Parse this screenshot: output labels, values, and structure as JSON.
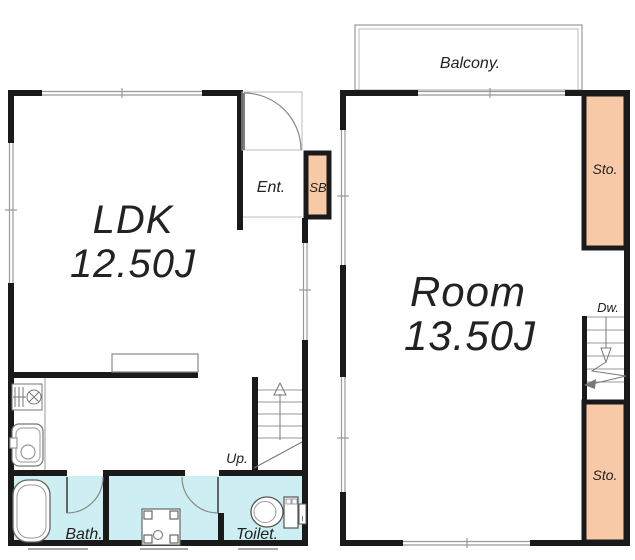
{
  "colors": {
    "wall": "#1a1a1a",
    "thin_line": "#999999",
    "fixture_line": "#666666",
    "storage_fill": "#f7c9a6",
    "wet_area_fill": "#cdeef2",
    "background": "#ffffff",
    "text": "#222222"
  },
  "floor1": {
    "room_label": "LDK",
    "room_size": "12.50J",
    "entrance_label": "Ent.",
    "shoebox_label": "SB",
    "stairs_label": "Up.",
    "bath_label": "Bath.",
    "toilet_label": "Toilet."
  },
  "floor2": {
    "room_label": "Room",
    "room_size": "13.50J",
    "balcony_label": "Balcony.",
    "storage_top_label": "Sto.",
    "stairs_label": "Dw.",
    "storage_bottom_label": "Sto."
  }
}
